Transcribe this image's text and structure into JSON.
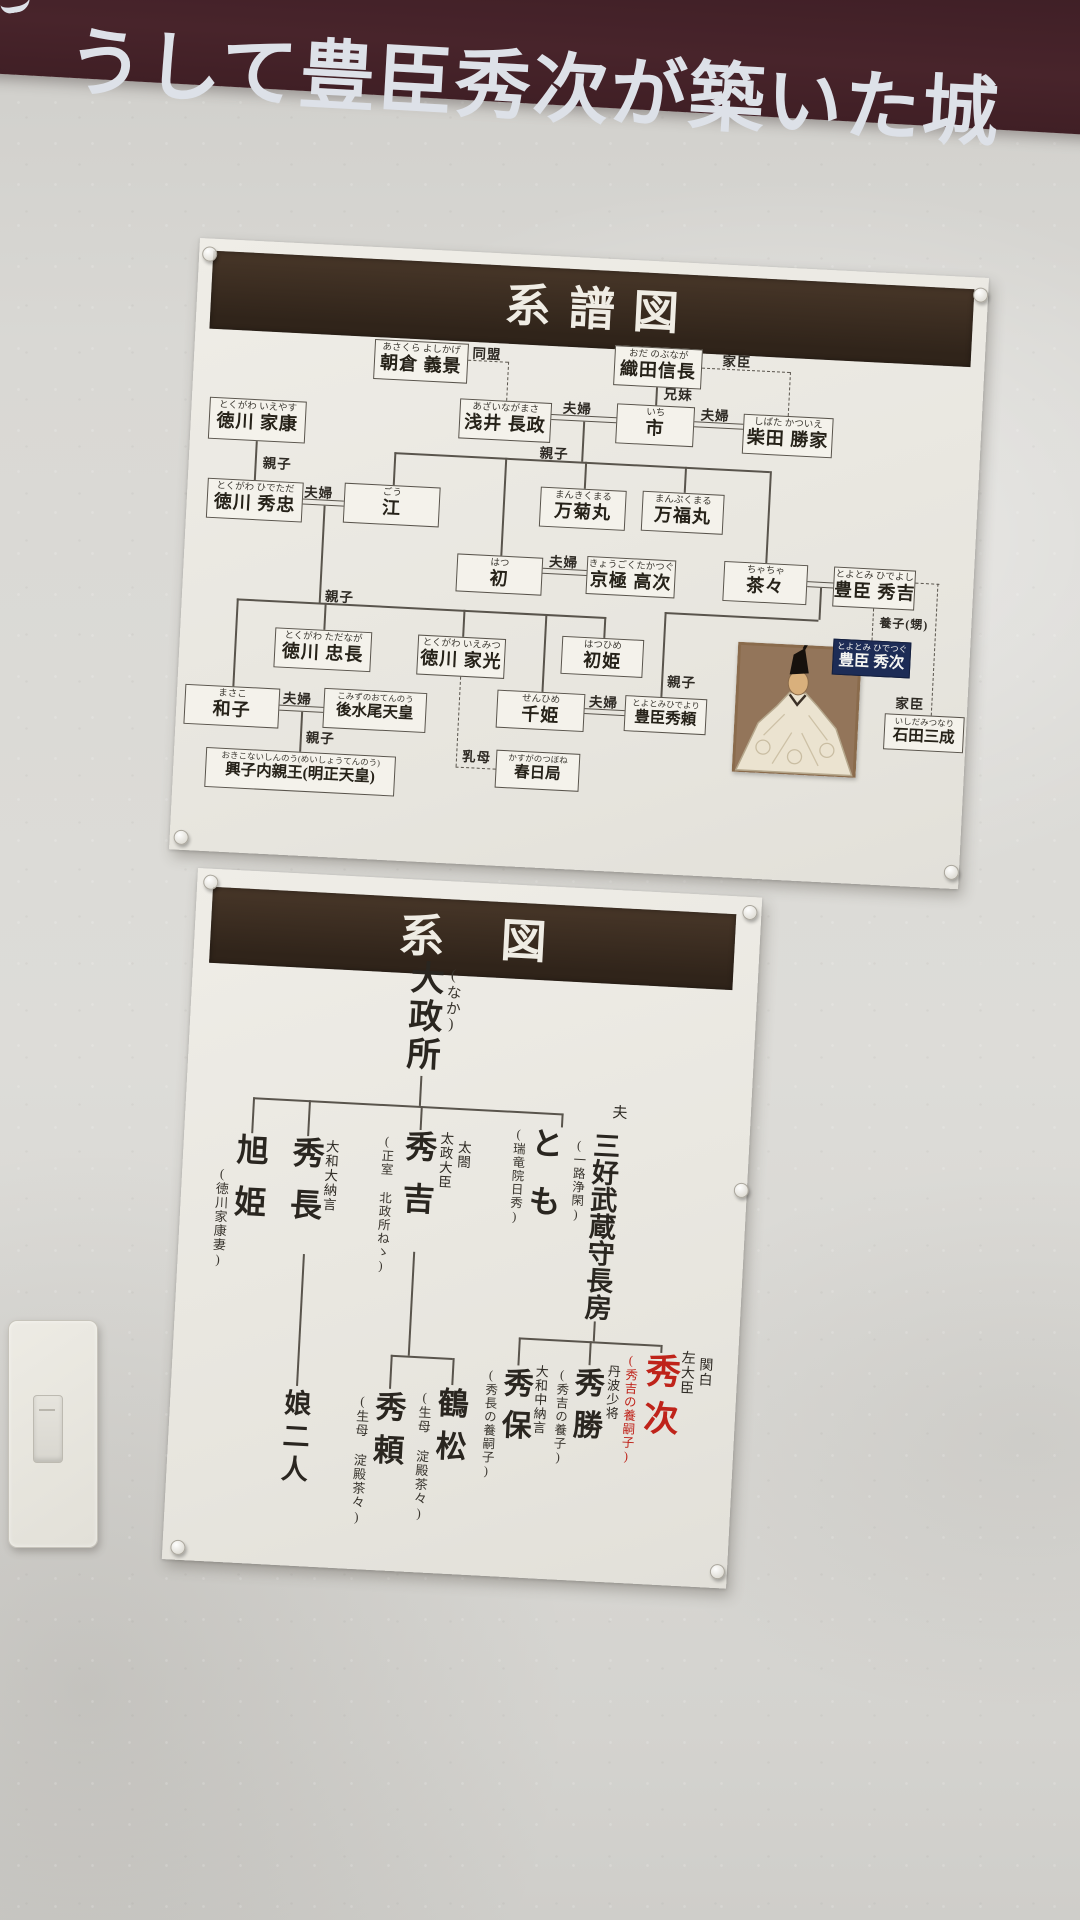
{
  "banner": {
    "text": "うして豊臣秀次が築いた城"
  },
  "colors": {
    "banner_maroon": "#48242b",
    "title_bar_brown": "#3a2c1f",
    "highlight_navy": "#1d2c56",
    "accent_red": "#bf231a",
    "paper": "#eceae3"
  },
  "p1": {
    "title": "系譜図",
    "labels": {
      "domei": "同盟",
      "kashin": "家臣",
      "kyodai": "兄妹",
      "fufu": "夫婦",
      "oyako": "親子",
      "uba": "乳母",
      "yoshi": "養子(甥)"
    },
    "nodes": [
      {
        "kana": "あさくら よしかげ",
        "name": "朝倉 義景"
      },
      {
        "kana": "おだ のぶなが",
        "name": "織田信長"
      },
      {
        "kana": "とくがわ いえやす",
        "name": "徳川 家康"
      },
      {
        "kana": "あざいながまさ",
        "name": "浅井 長政"
      },
      {
        "kana": "いち",
        "name": "市"
      },
      {
        "kana": "しばた かついえ",
        "name": "柴田 勝家"
      },
      {
        "kana": "とくがわ ひでただ",
        "name": "徳川 秀忠"
      },
      {
        "kana": "ごう",
        "name": "江"
      },
      {
        "kana": "まんきくまる",
        "name": "万菊丸"
      },
      {
        "kana": "まんぷくまる",
        "name": "万福丸"
      },
      {
        "kana": "はつ",
        "name": "初"
      },
      {
        "kana": "きょうごくたかつぐ",
        "name": "京極 高次"
      },
      {
        "kana": "ちゃちゃ",
        "name": "茶々"
      },
      {
        "kana": "とよとみ ひでよし",
        "name": "豊臣 秀吉"
      },
      {
        "kana": "とくがわ ただなが",
        "name": "徳川 忠長"
      },
      {
        "kana": "とくがわ いえみつ",
        "name": "徳川 家光"
      },
      {
        "kana": "はつひめ",
        "name": "初姫"
      },
      {
        "kana": "まさこ",
        "name": "和子"
      },
      {
        "kana": "こみずのおてんのう",
        "name": "後水尾天皇"
      },
      {
        "kana": "せんひめ",
        "name": "千姫"
      },
      {
        "kana": "とよとみひでより",
        "name": "豊臣秀頼"
      },
      {
        "kana": "おきこないしんのう(めいしょうてんのう)",
        "name": "興子内親王(明正天皇)"
      },
      {
        "kana": "かすがのつぼね",
        "name": "春日局"
      },
      {
        "kana": "いしだみつなり",
        "name": "石田三成"
      },
      {
        "kana": "とよとみ ひでつぐ",
        "name": "豊臣 秀次"
      }
    ]
  },
  "p2": {
    "title": "系図",
    "husband_label": "夫",
    "root": {
      "name": "大政所",
      "kana": "(なか)"
    },
    "gen1": [
      {
        "name": "旭姫",
        "note": "(徳川家康妻)"
      },
      {
        "name": "秀長",
        "title": "大和大納言"
      },
      {
        "name": "秀吉",
        "title": "太政大臣",
        "title2": "太閤",
        "note": "(正室 北政所ねゝ)"
      },
      {
        "name": "とも",
        "note": "(瑞竜院日秀)"
      },
      {
        "name": "三好武蔵守長房",
        "note": "(一路浄閑)"
      }
    ],
    "gen2": [
      {
        "name": "娘二人"
      },
      {
        "name": "秀頼",
        "note": "(生母 淀殿茶々)"
      },
      {
        "name": "鶴松",
        "note": "(生母 淀殿茶々)"
      },
      {
        "name": "秀保",
        "title": "大和中納言",
        "note": "(秀長の養嗣子)"
      },
      {
        "name": "秀勝",
        "title": "丹波少将",
        "note": "(秀吉の養子)"
      },
      {
        "name": "秀次",
        "title": "左大臣",
        "title2": "関白",
        "note": "(秀吉の養嗣子)"
      }
    ]
  }
}
